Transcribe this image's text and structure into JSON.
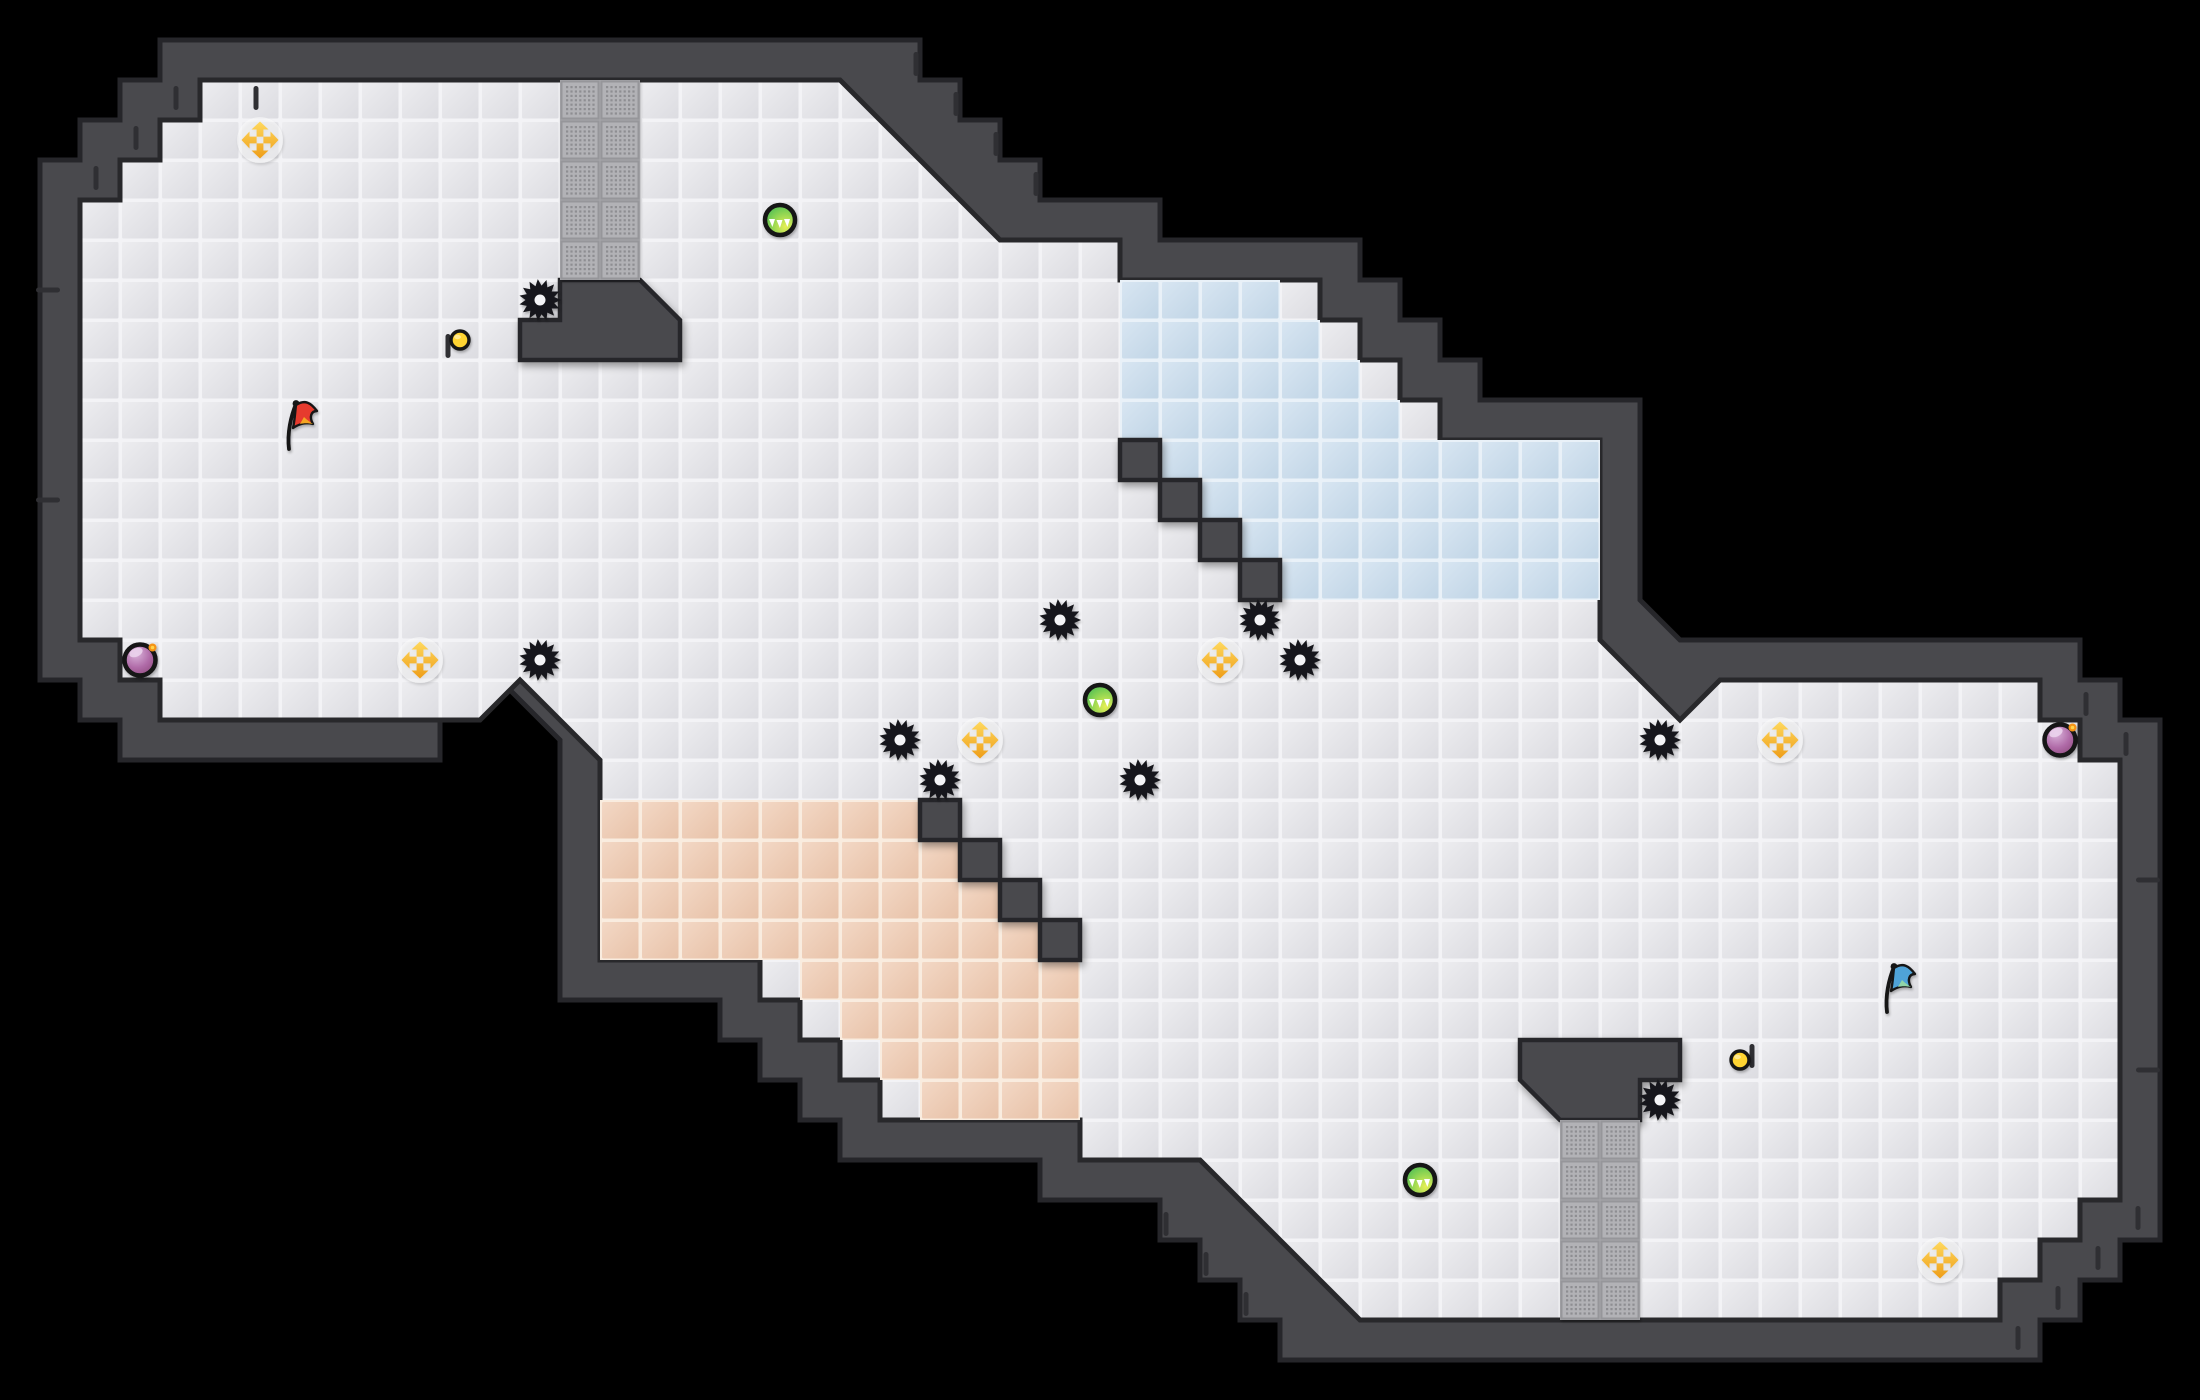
{
  "meta": {
    "kind": "capture-the-flag tile map",
    "width": 2200,
    "height": 1400,
    "tile_size": 40
  },
  "colors": {
    "background": "#000000",
    "wall_fill": "#4a4a4e",
    "wall_outline": "#28282b",
    "tick": "#2f2f33",
    "floor_seam": "#f3f3f6",
    "floor_hi": "#ededf0",
    "floor_lo": "#dcdce1",
    "blue_seam": "#e9f1f8",
    "blue_hi": "#d8e6f2",
    "blue_lo": "#c1d5e6",
    "salmon_seam": "#f9ecdf",
    "salmon_hi": "#f3d8c5",
    "salmon_lo": "#e8c2a9",
    "gate_bg": "#a6a6aa",
    "gate_tile": "#b2b2b6",
    "gate_border": "#96969a",
    "gate_dot": "#8e8e92",
    "spike_body": "#18181a",
    "spike_hole": "#f4f4f6",
    "boost_gold_hi": "#ffd95e",
    "boost_gold_lo": "#ee9d18",
    "boost_halo": "#ffffff",
    "power_green_a": "#e6ef55",
    "power_green_b": "#7ccf52",
    "power_green_c": "#2fae5c",
    "bomb_a": "#d9b3da",
    "bomb_b": "#b06ba8",
    "bomb_c": "#7e3a67",
    "bomb_spark": "#f59214",
    "coin_fill": "#ffd431",
    "ring_dark": "#141416",
    "flag_red_main": "#e63b2e",
    "flag_red_accent": "#f5a623",
    "flag_blue_main": "#4fa3d8",
    "flag_blue_accent": "#8fd4a8"
  },
  "map": {
    "outer_wall_outline": [
      [
        160,
        40
      ],
      [
        920,
        40
      ],
      [
        920,
        80
      ],
      [
        960,
        80
      ],
      [
        960,
        120
      ],
      [
        1000,
        120
      ],
      [
        1000,
        160
      ],
      [
        1040,
        160
      ],
      [
        1040,
        200
      ],
      [
        1160,
        200
      ],
      [
        1160,
        240
      ],
      [
        1360,
        240
      ],
      [
        1360,
        280
      ],
      [
        1400,
        280
      ],
      [
        1400,
        320
      ],
      [
        1440,
        320
      ],
      [
        1440,
        360
      ],
      [
        1480,
        360
      ],
      [
        1480,
        400
      ],
      [
        1640,
        400
      ],
      [
        1640,
        600
      ],
      [
        1680,
        640
      ],
      [
        2080,
        640
      ],
      [
        2080,
        680
      ],
      [
        2120,
        680
      ],
      [
        2120,
        720
      ],
      [
        2160,
        720
      ],
      [
        2160,
        1240
      ],
      [
        2120,
        1240
      ],
      [
        2120,
        1280
      ],
      [
        2080,
        1280
      ],
      [
        2080,
        1320
      ],
      [
        2040,
        1320
      ],
      [
        2040,
        1360
      ],
      [
        1320,
        1360
      ],
      [
        1280,
        1360
      ],
      [
        1280,
        1320
      ],
      [
        1240,
        1320
      ],
      [
        1240,
        1280
      ],
      [
        1200,
        1280
      ],
      [
        1200,
        1240
      ],
      [
        1160,
        1240
      ],
      [
        1160,
        1200
      ],
      [
        1040,
        1200
      ],
      [
        1040,
        1160
      ],
      [
        880,
        1160
      ],
      [
        840,
        1160
      ],
      [
        840,
        1120
      ],
      [
        800,
        1120
      ],
      [
        800,
        1080
      ],
      [
        760,
        1080
      ],
      [
        760,
        1040
      ],
      [
        720,
        1040
      ],
      [
        720,
        1000
      ],
      [
        560,
        1000
      ],
      [
        560,
        740
      ],
      [
        480,
        660
      ],
      [
        440,
        700
      ],
      [
        440,
        760
      ],
      [
        120,
        760
      ],
      [
        120,
        720
      ],
      [
        80,
        720
      ],
      [
        80,
        680
      ],
      [
        40,
        680
      ],
      [
        40,
        160
      ],
      [
        80,
        160
      ],
      [
        80,
        120
      ],
      [
        120,
        120
      ],
      [
        120,
        80
      ],
      [
        160,
        80
      ]
    ],
    "floor_outline": [
      [
        200,
        80
      ],
      [
        840,
        80
      ],
      [
        1000,
        240
      ],
      [
        1120,
        240
      ],
      [
        1120,
        280
      ],
      [
        1320,
        280
      ],
      [
        1320,
        320
      ],
      [
        1360,
        320
      ],
      [
        1360,
        360
      ],
      [
        1400,
        360
      ],
      [
        1400,
        400
      ],
      [
        1440,
        400
      ],
      [
        1440,
        440
      ],
      [
        1600,
        440
      ],
      [
        1600,
        640
      ],
      [
        1680,
        720
      ],
      [
        1720,
        680
      ],
      [
        2040,
        680
      ],
      [
        2040,
        720
      ],
      [
        2080,
        720
      ],
      [
        2080,
        760
      ],
      [
        2120,
        760
      ],
      [
        2120,
        1200
      ],
      [
        2080,
        1200
      ],
      [
        2080,
        1240
      ],
      [
        2040,
        1240
      ],
      [
        2040,
        1280
      ],
      [
        2000,
        1280
      ],
      [
        2000,
        1320
      ],
      [
        1360,
        1320
      ],
      [
        1200,
        1160
      ],
      [
        1080,
        1160
      ],
      [
        1080,
        1120
      ],
      [
        920,
        1120
      ],
      [
        880,
        1120
      ],
      [
        880,
        1080
      ],
      [
        840,
        1080
      ],
      [
        840,
        1040
      ],
      [
        800,
        1040
      ],
      [
        800,
        1000
      ],
      [
        760,
        1000
      ],
      [
        760,
        960
      ],
      [
        600,
        960
      ],
      [
        600,
        760
      ],
      [
        520,
        680
      ],
      [
        480,
        720
      ],
      [
        160,
        720
      ],
      [
        160,
        680
      ],
      [
        120,
        680
      ],
      [
        120,
        640
      ],
      [
        80,
        640
      ],
      [
        80,
        200
      ],
      [
        120,
        200
      ],
      [
        120,
        160
      ],
      [
        160,
        160
      ],
      [
        160,
        120
      ],
      [
        200,
        120
      ]
    ],
    "inner_wall_pieces": [
      {
        "name": "top-funnel-wall",
        "points": [
          [
            560,
            280
          ],
          [
            640,
            280
          ],
          [
            680,
            320
          ],
          [
            680,
            360
          ],
          [
            520,
            360
          ],
          [
            520,
            320
          ],
          [
            560,
            320
          ]
        ]
      },
      {
        "name": "bottom-funnel-wall",
        "points": [
          [
            1520,
            1040
          ],
          [
            1680,
            1040
          ],
          [
            1680,
            1080
          ],
          [
            1640,
            1080
          ],
          [
            1640,
            1120
          ],
          [
            1560,
            1120
          ],
          [
            1520,
            1080
          ]
        ]
      },
      {
        "name": "blue-zone-stair-wall",
        "points": [
          [
            1120,
            440
          ],
          [
            1160,
            440
          ],
          [
            1160,
            480
          ],
          [
            1200,
            480
          ],
          [
            1200,
            520
          ],
          [
            1240,
            520
          ],
          [
            1240,
            560
          ],
          [
            1280,
            560
          ],
          [
            1280,
            600
          ],
          [
            1240,
            600
          ],
          [
            1240,
            560
          ],
          [
            1200,
            560
          ],
          [
            1200,
            520
          ],
          [
            1160,
            520
          ],
          [
            1160,
            480
          ],
          [
            1120,
            480
          ]
        ]
      },
      {
        "name": "red-zone-stair-wall",
        "points": [
          [
            920,
            800
          ],
          [
            960,
            800
          ],
          [
            960,
            840
          ],
          [
            1000,
            840
          ],
          [
            1000,
            880
          ],
          [
            1040,
            880
          ],
          [
            1040,
            920
          ],
          [
            1080,
            920
          ],
          [
            1080,
            960
          ],
          [
            1040,
            960
          ],
          [
            1040,
            920
          ],
          [
            1000,
            920
          ],
          [
            1000,
            880
          ],
          [
            960,
            880
          ],
          [
            960,
            840
          ],
          [
            920,
            840
          ]
        ]
      }
    ],
    "blue_zone_rows": [
      [
        1120,
        280,
        1280
      ],
      [
        1120,
        320,
        1320
      ],
      [
        1120,
        360,
        1360
      ],
      [
        1120,
        400,
        1400
      ],
      [
        1160,
        440,
        1600
      ],
      [
        1200,
        480,
        1600
      ],
      [
        1240,
        520,
        1600
      ],
      [
        1280,
        560,
        1600
      ]
    ],
    "red_zone_rows": [
      [
        600,
        800,
        920
      ],
      [
        600,
        840,
        960
      ],
      [
        600,
        880,
        1000
      ],
      [
        600,
        920,
        1040
      ],
      [
        800,
        960,
        1080
      ],
      [
        840,
        1000,
        1080
      ],
      [
        880,
        1040,
        1080
      ],
      [
        920,
        1080,
        1080
      ]
    ],
    "gates": [
      {
        "name": "top-gate",
        "x": 560,
        "y": 80,
        "w": 80,
        "h": 200
      },
      {
        "name": "bottom-gate",
        "x": 1560,
        "y": 1120,
        "w": 80,
        "h": 200
      }
    ],
    "ticks_v": [
      [
        176,
        86
      ],
      [
        136,
        126
      ],
      [
        96,
        166
      ],
      [
        916,
        52
      ],
      [
        956,
        92
      ],
      [
        996,
        132
      ],
      [
        1036,
        172
      ],
      [
        2018,
        1326
      ],
      [
        2058,
        1286
      ],
      [
        2098,
        1246
      ],
      [
        2138,
        1206
      ],
      [
        1166,
        1212
      ],
      [
        1206,
        1252
      ],
      [
        1246,
        1292
      ],
      [
        2086,
        692
      ],
      [
        2126,
        732
      ],
      [
        448,
        334
      ],
      [
        1752,
        1044
      ],
      [
        256,
        86
      ]
    ],
    "ticks_h": [
      [
        48,
        290
      ],
      [
        48,
        500
      ],
      [
        2148,
        880
      ],
      [
        2148,
        1070
      ]
    ]
  },
  "entities": {
    "spikes": [
      [
        540,
        300
      ],
      [
        1060,
        620
      ],
      [
        1260,
        620
      ],
      [
        1300,
        660
      ],
      [
        540,
        660
      ],
      [
        900,
        740
      ],
      [
        940,
        780
      ],
      [
        1140,
        780
      ],
      [
        1660,
        740
      ],
      [
        1660,
        1100
      ]
    ],
    "boosts": [
      [
        260,
        140
      ],
      [
        420,
        660
      ],
      [
        1220,
        660
      ],
      [
        980,
        740
      ],
      [
        1780,
        740
      ],
      [
        1940,
        1260
      ]
    ],
    "powerups": [
      [
        780,
        220
      ],
      [
        1100,
        700
      ],
      [
        1420,
        1180
      ]
    ],
    "bombs": [
      [
        140,
        660
      ],
      [
        2060,
        740
      ]
    ],
    "coins": [
      [
        460,
        340
      ],
      [
        1740,
        1060
      ]
    ],
    "flags": [
      {
        "x": 300,
        "y": 425,
        "team": "red"
      },
      {
        "x": 1898,
        "y": 988,
        "team": "blue"
      }
    ]
  }
}
